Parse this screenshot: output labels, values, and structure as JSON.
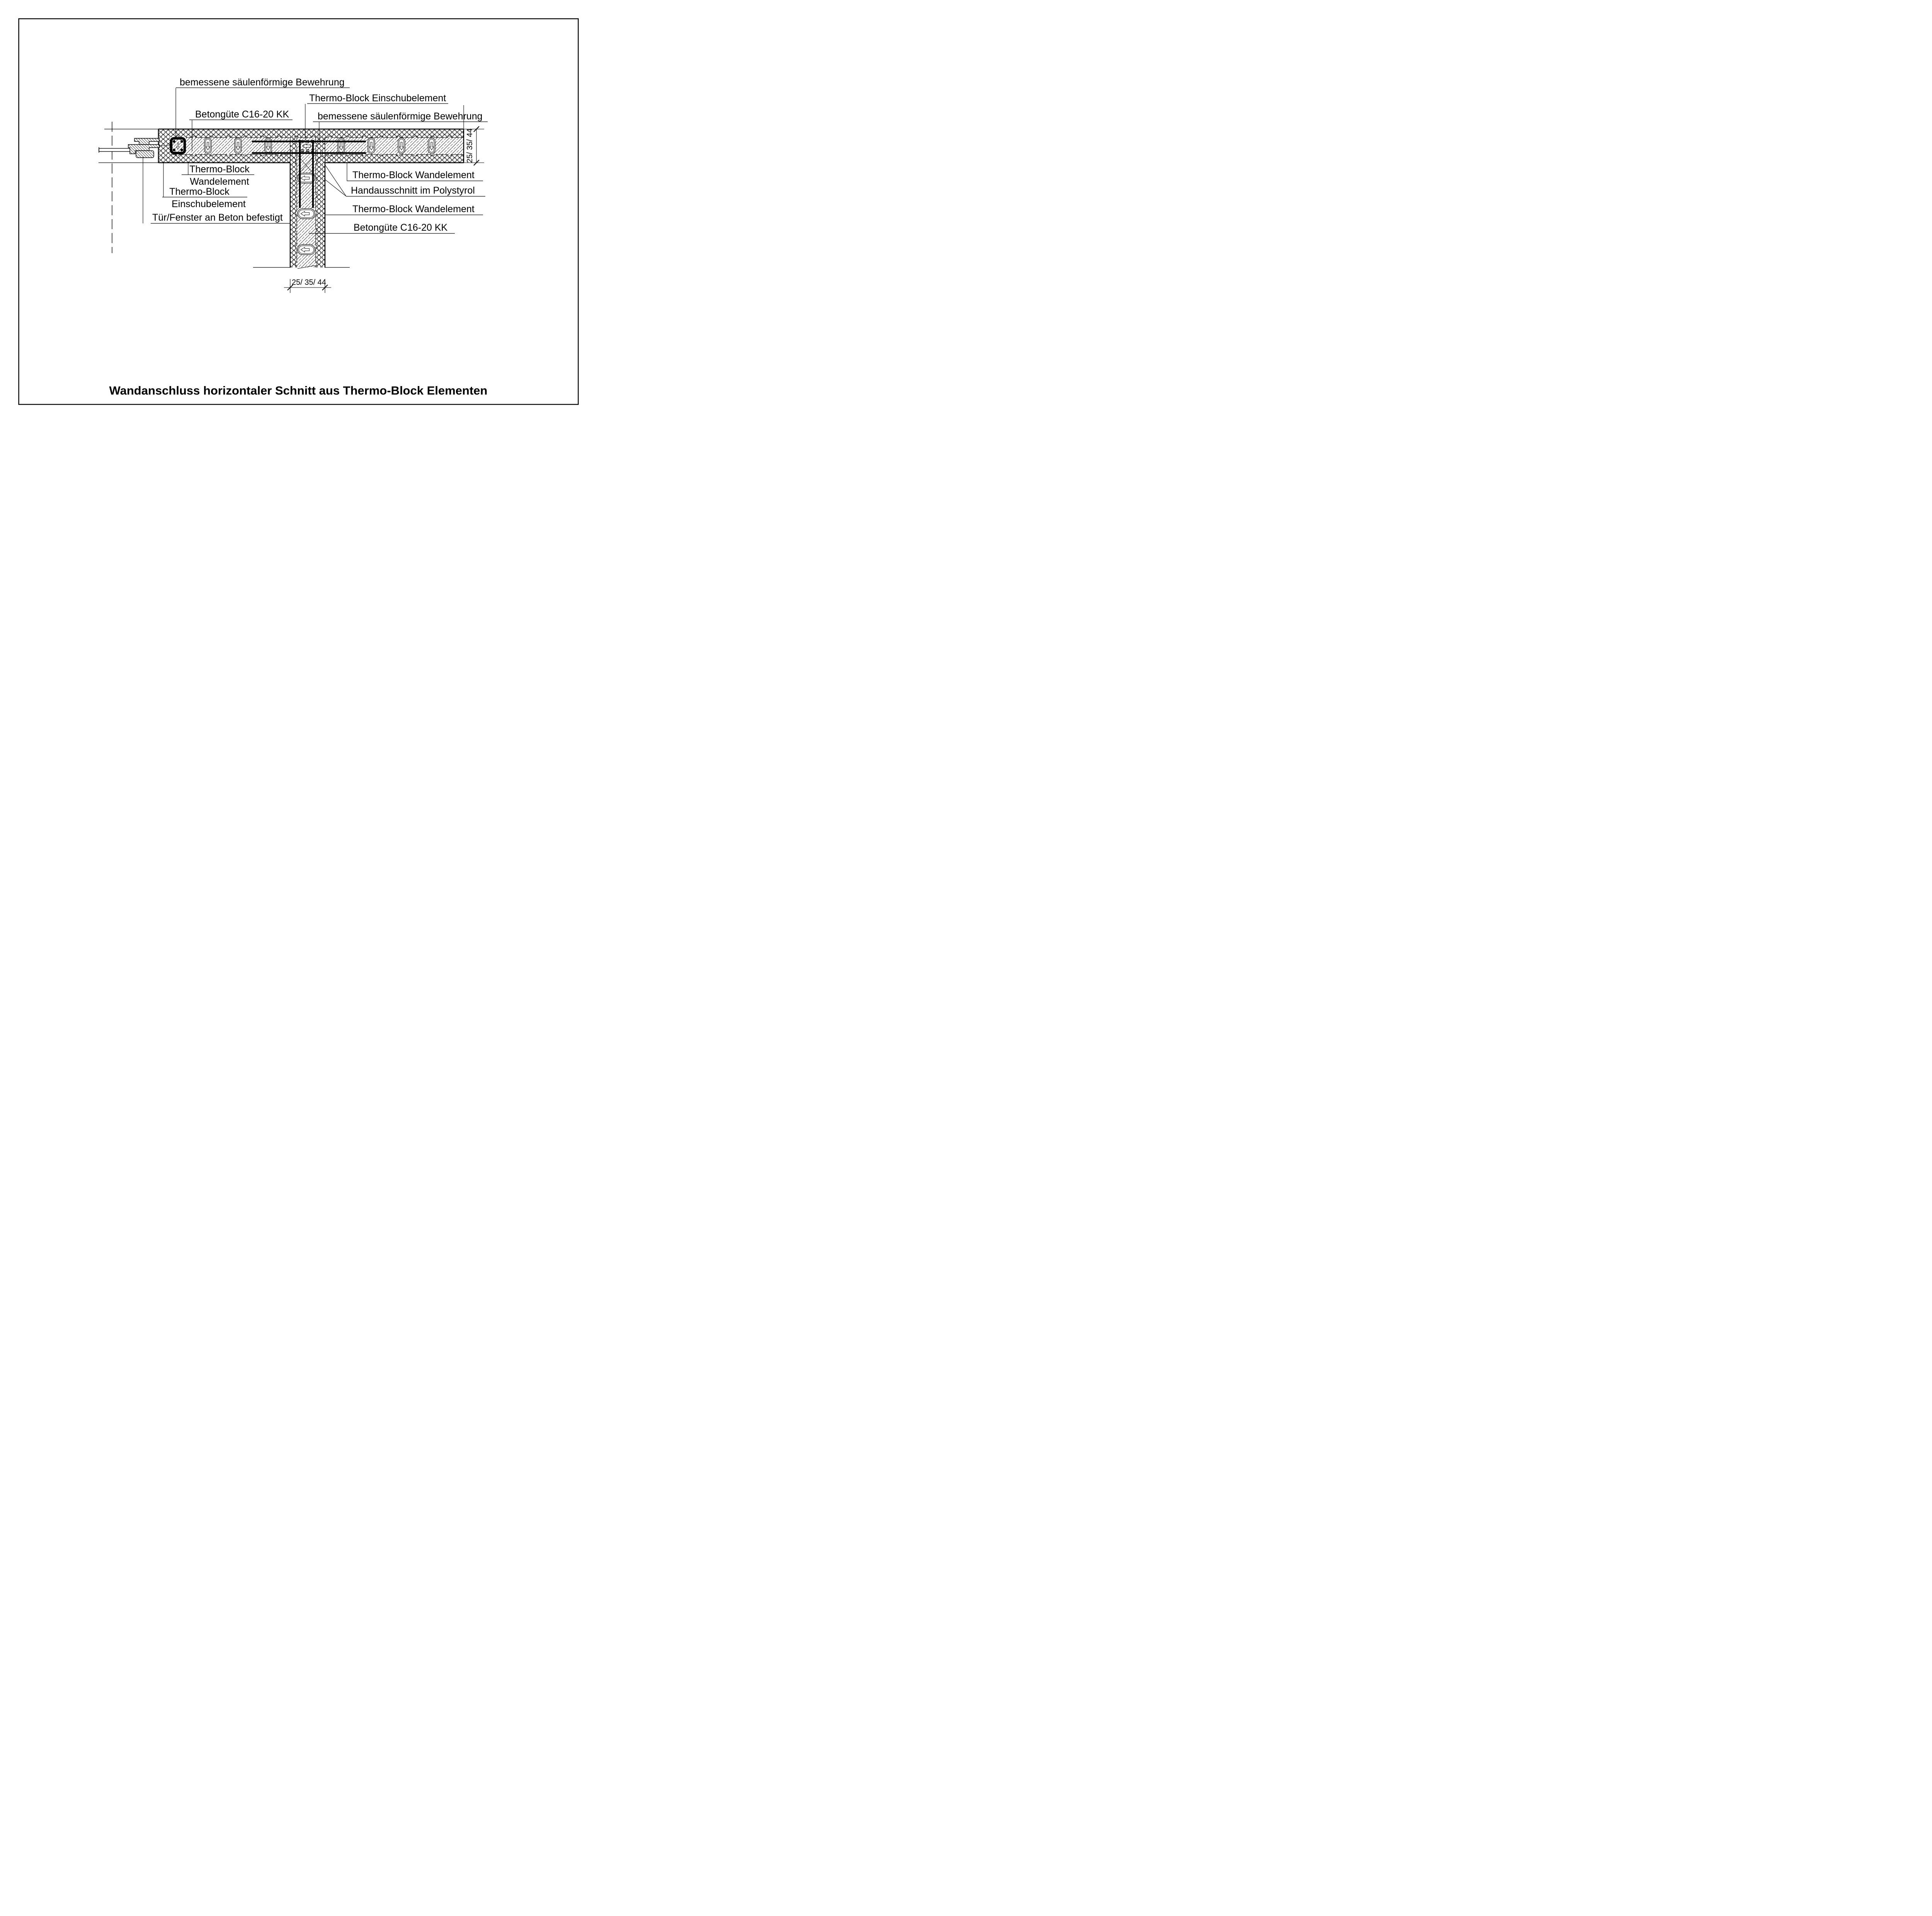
{
  "drawing": {
    "title": "Wandanschluss horizontaler Schnitt aus Thermo-Block Elementen",
    "annotations": {
      "top_left_bewehrung": "bemessene säulenförmige Bewehrung",
      "top_einschub": "Thermo-Block Einschubelement",
      "top_betonguete": "Betongüte C16-20 KK",
      "top_right_bewehrung": "bemessene säulenförmige Bewehrung",
      "left_wandelement": {
        "line1": "Thermo-Block",
        "line2": "Wandelement"
      },
      "left_einschub": {
        "line1": "Thermo-Block",
        "line2": "Einschubelement"
      },
      "left_tuer_fenster": "Tür/Fenster an Beton befestigt",
      "right_wandelement_1": "Thermo-Block Wandelement",
      "right_handausschnitt": "Handausschnitt im Polystyrol",
      "right_wandelement_2": "Thermo-Block Wandelement",
      "right_betonguete": "Betongüte C16-20 KK"
    },
    "dimensions": {
      "right": "25/ 35/ 44",
      "bottom": "25/ 35/ 44"
    },
    "colors": {
      "ink": "#000000",
      "paper": "#ffffff"
    }
  }
}
